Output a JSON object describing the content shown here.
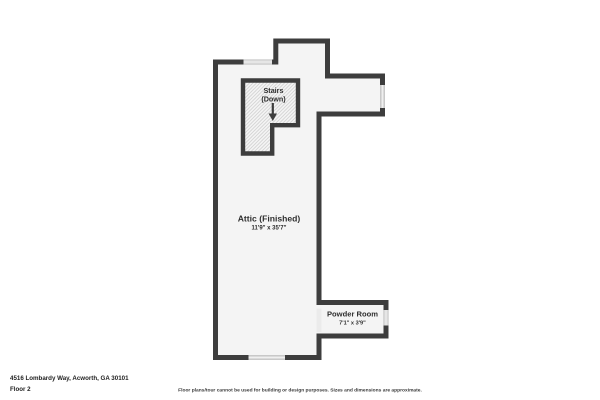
{
  "colors": {
    "wall": "#3d3d3d",
    "floor": "#f4f4f4",
    "window": "#d7d7d7",
    "hatch_line": "#d4d4d4",
    "opening": "#ebebeb",
    "text": "#2e2e2e",
    "background": "#ffffff"
  },
  "floorplan": {
    "rooms": {
      "stairs": {
        "label": "Stairs",
        "sublabel": "(Down)"
      },
      "attic": {
        "label": "Attic (Finished)",
        "dimensions": "11'9\" x 35'7\""
      },
      "powder_room": {
        "label": "Powder Room",
        "dimensions": "7'1\" x 3'9\""
      }
    }
  },
  "footer": {
    "address": "4516 Lombardy Way, Acworth, GA 30101",
    "floor_label": "Floor 2",
    "disclaimer": "Floor plans/tour cannot be used for building or design purposes. Sizes and dimensions are approximate."
  }
}
